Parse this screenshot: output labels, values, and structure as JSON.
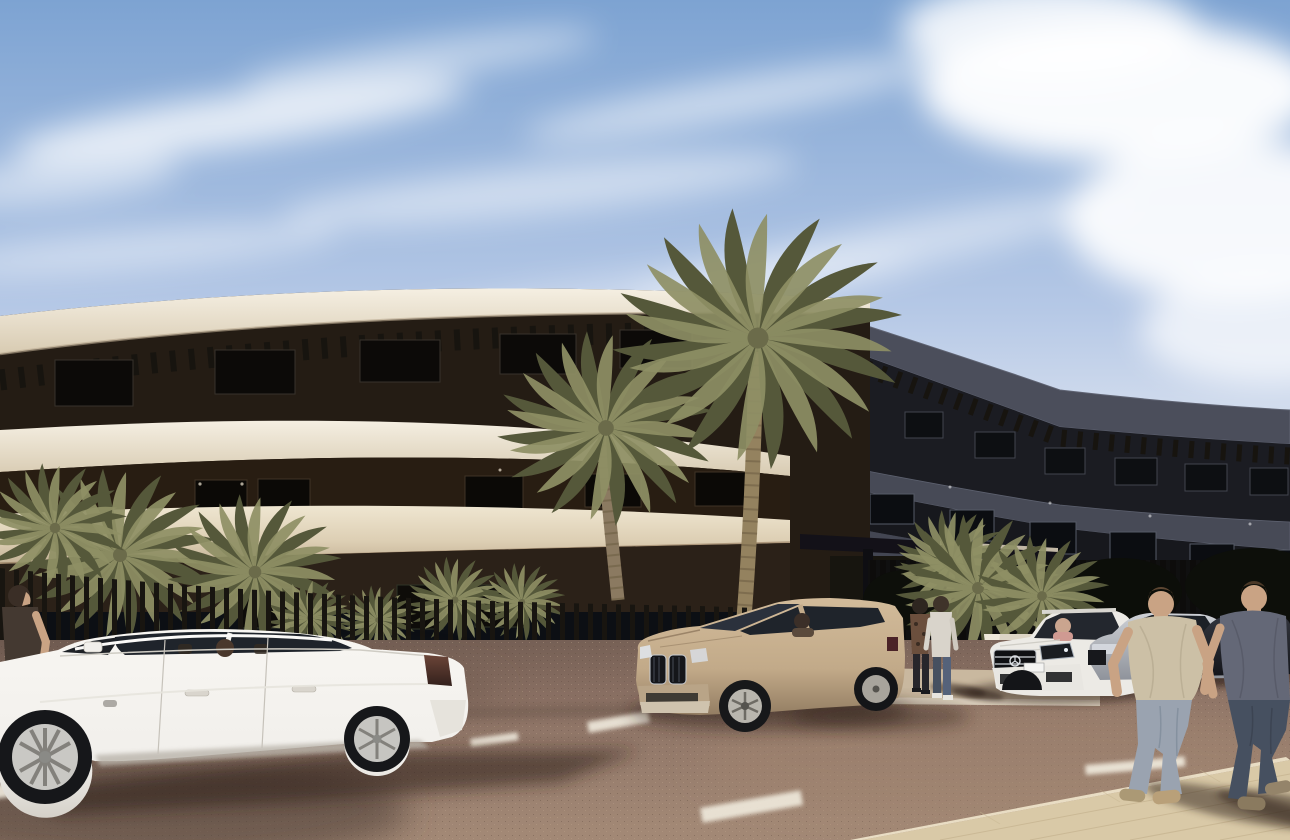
{
  "wall": {
    "sign_text": "TO"
  },
  "palette": {
    "sky_top": "#7da3d2",
    "sky_mid": "#b5c8e6",
    "sky_horizon": "#dde4f0",
    "cloud": "#ffffff",
    "band_cream": "#ece4d4",
    "band_cream_dark": "#cdbfa6",
    "soffit_warm": "#a98a6e",
    "recess_dark": "#241c14",
    "window_glass": "#0d0f12",
    "facade_right": "#474a56",
    "facade_right_dark": "#1b1c22",
    "pergola": "#17140f",
    "fence": "#181510",
    "wall_pink": "#c7b6b2",
    "wall_sign": "#f5f3ef",
    "curb": "#d8ccba",
    "road": "#8b7164",
    "road_dark": "#5e4c42",
    "sidewalk": "#d9c9a7",
    "palm_green": "#8f9065",
    "palm_dark": "#55583a",
    "trunk": "#8b7a61",
    "car_white": "#f1efeb",
    "suv_tan": "#c2aa89",
    "car_silver": "#b7bac0",
    "car_charcoal": "#26282e",
    "glass": "#1f242b",
    "skin": "#c9a384",
    "tee_tan": "#ccc0a6",
    "tee_gray": "#646877",
    "jeans_light": "#9aa3b0",
    "jeans_dark": "#465060",
    "shadow": "#2a1d16"
  }
}
